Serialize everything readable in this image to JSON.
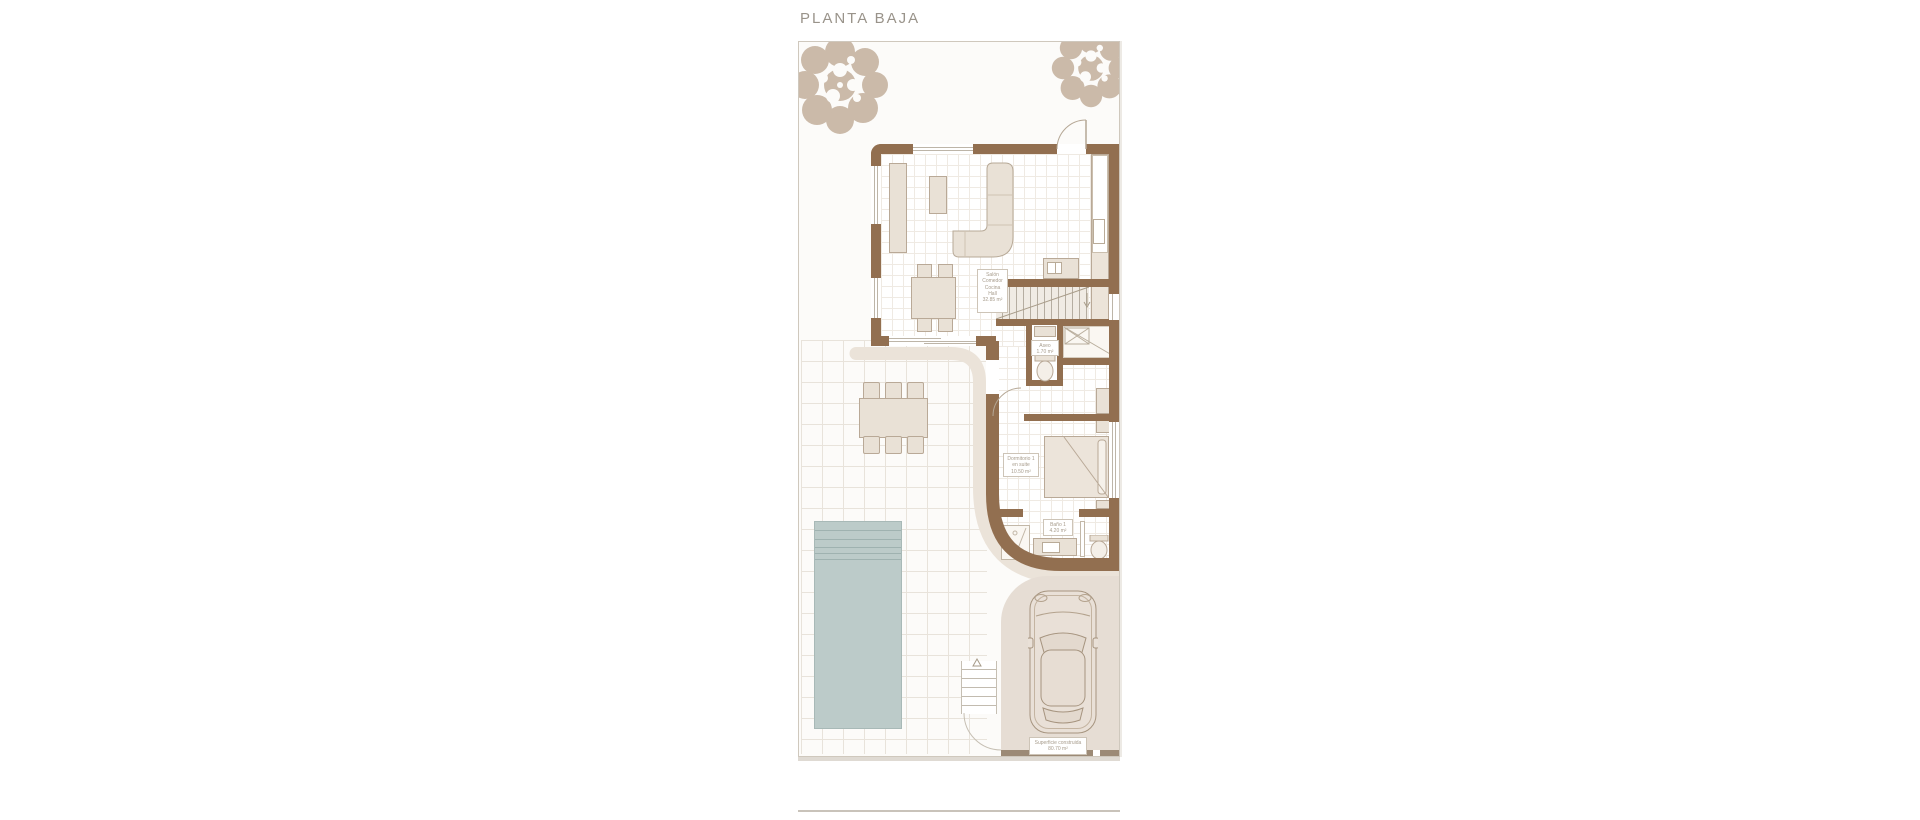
{
  "title": "PLANTA BAJA",
  "rooms": {
    "salon": {
      "lines": [
        "Salón",
        "Comedor",
        "Cocina",
        "Hall",
        "32.85 m²"
      ]
    },
    "aseo": {
      "lines": [
        "Aseo",
        "1.70 m²"
      ]
    },
    "dormitorio": {
      "lines": [
        "Dormitorio 1",
        "en suite",
        "10.50 m²"
      ]
    },
    "bano": {
      "lines": [
        "Baño 1",
        "4.20 m²"
      ]
    },
    "superficie": {
      "lines": [
        "Superficie construida",
        "80.70 m²"
      ]
    }
  },
  "colors": {
    "wall": "#926f50",
    "furniture": "#e9e1d6",
    "porch": "#ebe3d9",
    "pool": "#bccbc9",
    "driveway": "#e6ddd4",
    "tree": "#cbbaa9",
    "label_text": "#a79c8c",
    "title_text": "#99938a"
  }
}
